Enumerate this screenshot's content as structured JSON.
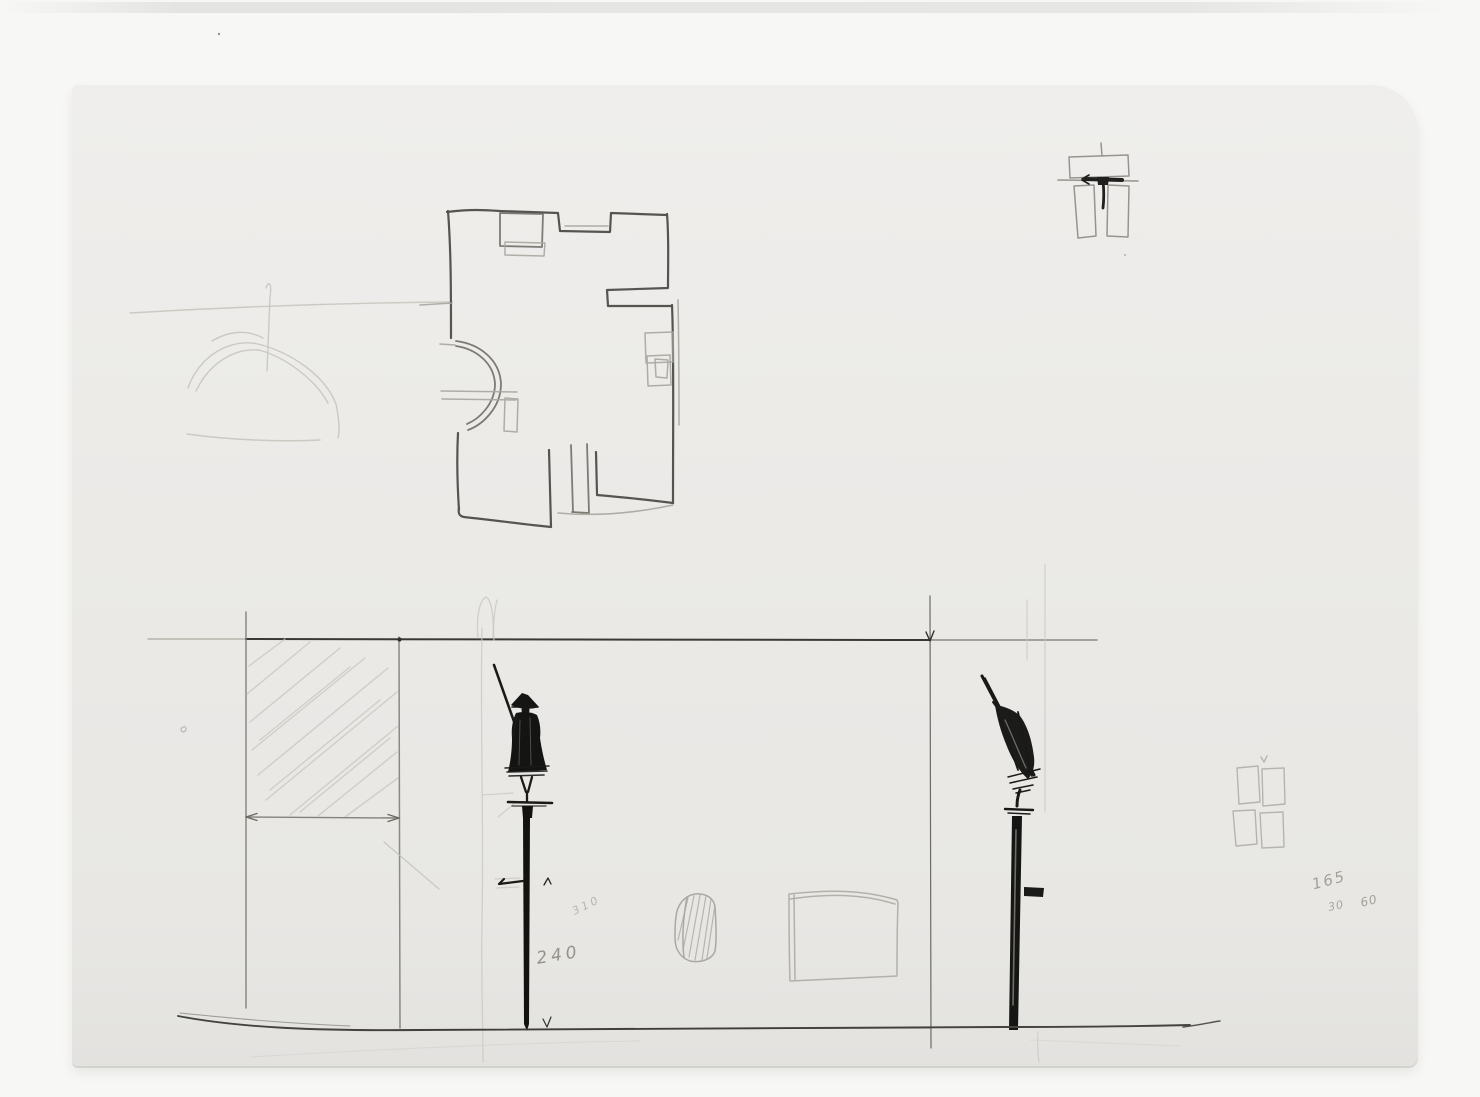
{
  "annotations": {
    "v310": "310",
    "v240": "240",
    "v165": "165",
    "v30": "30",
    "v60": "60"
  },
  "colors": {
    "photo_background": "#f7f7f5",
    "sheet_paper": "#ebeae7",
    "pencil_dark": "#1a1a18",
    "pencil_mid": "#6e6b65",
    "pencil_light": "#c4c1ba"
  }
}
